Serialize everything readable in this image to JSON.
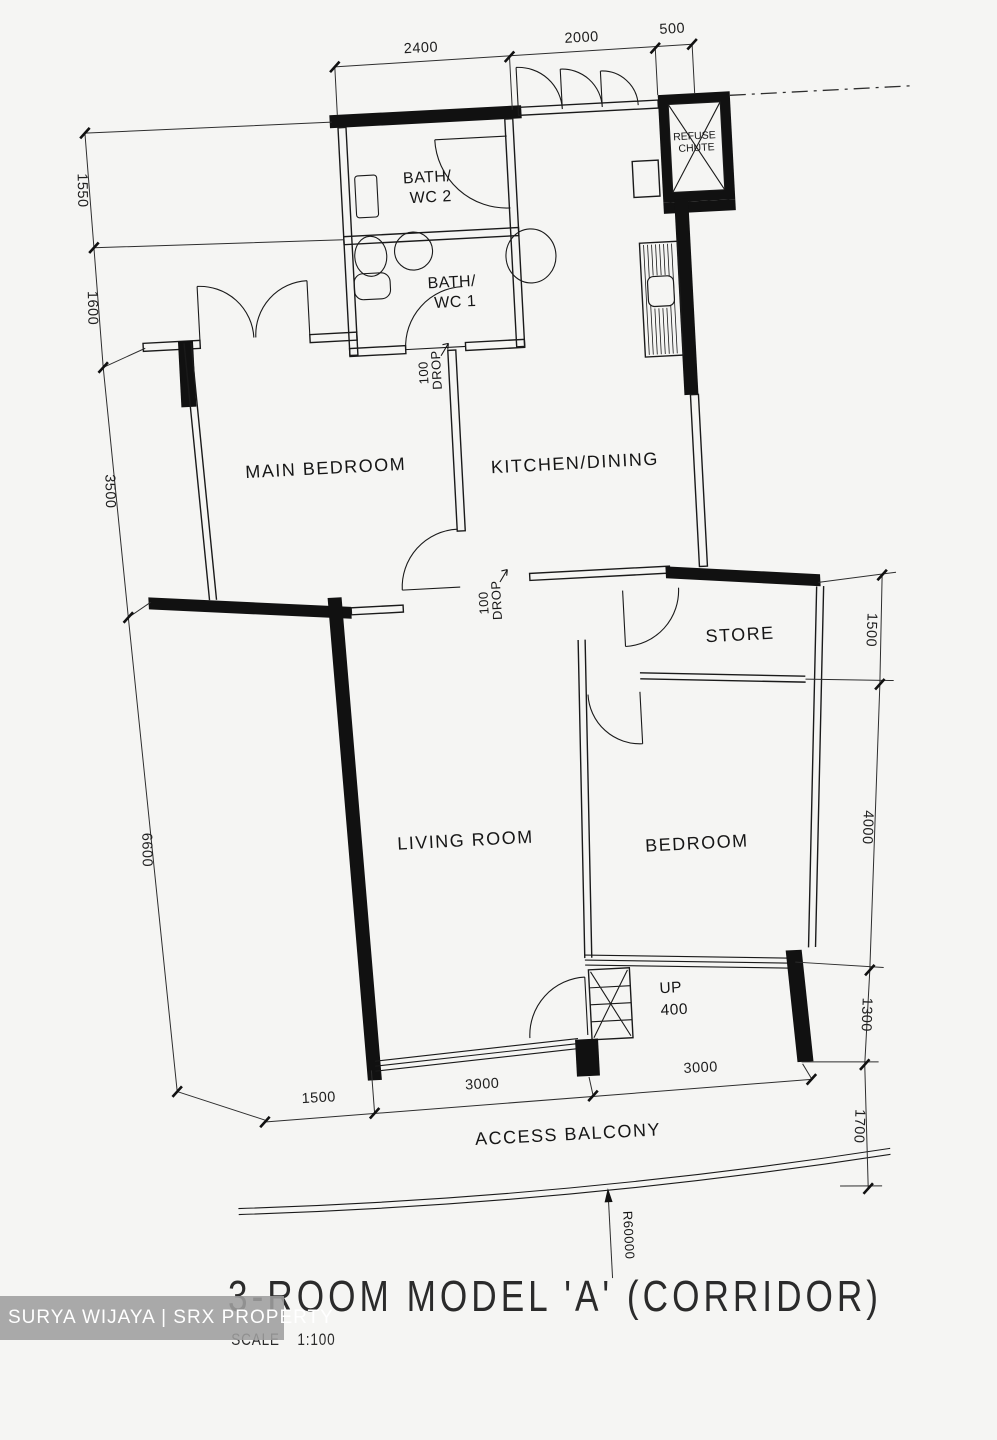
{
  "title": {
    "text": "3-ROOM MODEL 'A' (CORRIDOR)",
    "scale_label": "SCALE",
    "scale_value": "1:100"
  },
  "watermark": {
    "text": "SURYA WIJAYA | SRX PROPERTY"
  },
  "rooms": {
    "main_bedroom": "MAIN BEDROOM",
    "kitchen_dining": "KITCHEN/DINING",
    "living_room": "LIVING ROOM",
    "bedroom": "BEDROOM",
    "store": "STORE",
    "bath_wc2_line1": "BATH/",
    "bath_wc2_line2": "WC 2",
    "bath_wc1_line1": "BATH/",
    "bath_wc1_line2": "WC 1",
    "refuse_line1": "REFUSE",
    "refuse_line2": "CHUTE",
    "access_balcony": "ACCESS BALCONY"
  },
  "annotations": {
    "up_line1": "UP",
    "up_line2": "400",
    "drop1_line1": "100",
    "drop1_line2": "DROP",
    "drop2_line1": "100",
    "drop2_line2": "DROP",
    "radius": "R60000"
  },
  "dimensions": {
    "top": [
      "2400",
      "2000",
      "500"
    ],
    "left": [
      "1550",
      "1600",
      "3500",
      "6600"
    ],
    "right": [
      "1500",
      "4000",
      "1300",
      "1700"
    ],
    "bottom": [
      "1500",
      "3000",
      "3000"
    ]
  }
}
